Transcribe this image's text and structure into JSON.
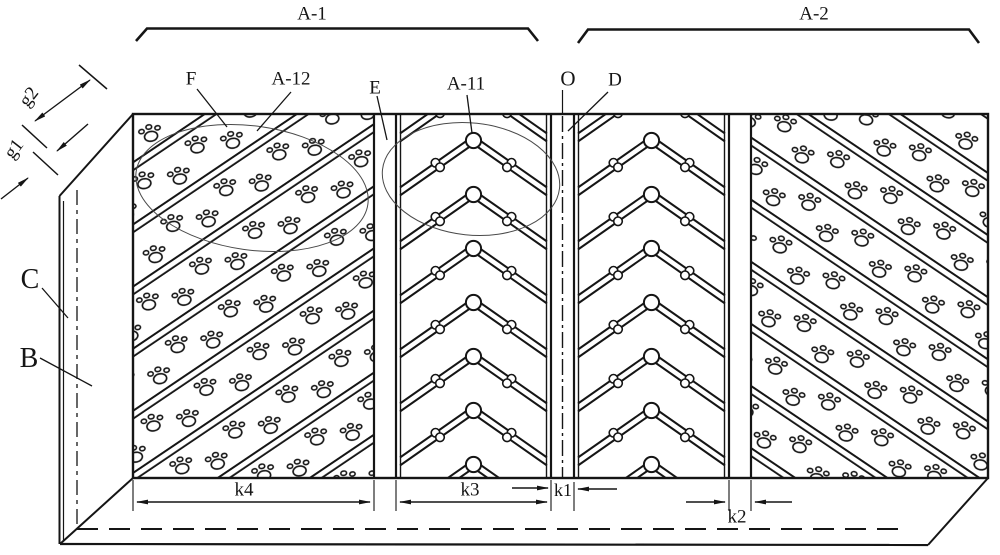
{
  "figure": {
    "region_labels": {
      "a1": "A-1",
      "a2": "A-2"
    },
    "part_labels": {
      "f": "F",
      "a12": "A-12",
      "e": "E",
      "a11": "A-11",
      "o": "O",
      "d": "D",
      "c": "C",
      "b": "B"
    },
    "dimension_labels": {
      "g1": "g1",
      "g2": "g2",
      "k1": "k1",
      "k2": "k2",
      "k3": "k3",
      "k4": "k4"
    },
    "colors": {
      "ink": "#151515",
      "background": "#ffffff",
      "thin_annotation": "#4a4a4a"
    }
  }
}
